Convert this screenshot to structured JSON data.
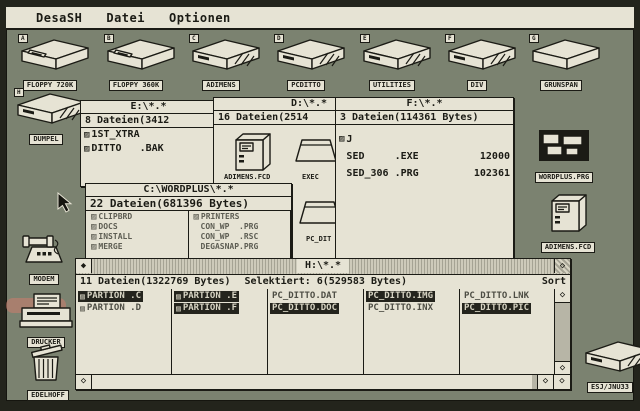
{
  "menu": {
    "items": [
      "DesaSH",
      "Datei",
      "Optionen"
    ]
  },
  "glyphs": {
    "marker": "▨",
    "diamond": "◇",
    "close": "◆"
  },
  "desktop": {
    "drive_icons": [
      {
        "letter": "A",
        "label": "FLOPPY 720K"
      },
      {
        "letter": "B",
        "label": "FLOPPY 360K"
      },
      {
        "letter": "C",
        "label": "ADIMENS"
      },
      {
        "letter": "D",
        "label": "PCDITTO"
      },
      {
        "letter": "E",
        "label": "UTILITIES"
      },
      {
        "letter": "F",
        "label": "DIV"
      },
      {
        "letter": "G",
        "label": "GRÜNSPAN"
      }
    ],
    "side_icons": [
      {
        "letter": "H",
        "label": "DUMPEL"
      },
      {
        "label": "MODEM"
      },
      {
        "label": "DRUCKER"
      },
      {
        "label": "EDELHOFF"
      }
    ],
    "file_icons": [
      {
        "label": "WORDPLUS.PRG"
      },
      {
        "label": "ADIMENS.FCD"
      },
      {
        "label": "ESJ/JNU33"
      }
    ]
  },
  "windows": {
    "e": {
      "title": "E:\\*.*",
      "info": "8 Dateien(3412",
      "files": [
        "1ST_XTRA",
        "DITTO   .BAK"
      ]
    },
    "d": {
      "title": "D:\\*.*",
      "info": "16 Dateien(2514",
      "items": [
        "ADIMENS.FCD",
        "EXEC",
        "PC_DIT"
      ]
    },
    "f": {
      "title": "F:\\*.*",
      "info": "3 Dateien(114361 Bytes)",
      "files": [
        {
          "name": "J",
          "size": ""
        },
        {
          "name": "SED     .EXE",
          "size": "12000"
        },
        {
          "name": "SED_306 .PRG",
          "size": "102361"
        }
      ]
    },
    "c": {
      "title": "C:\\WORDPLUS\\*.*",
      "info": "22 Dateien(681396 Bytes)",
      "col1": [
        "CLIPBRD",
        "DOCS",
        "INSTALL",
        "MERGE"
      ],
      "col2": [
        "PRINTERS",
        "CON_WP  .PRG",
        "CON_WP  .RSC",
        "DEGASNAP.PRG"
      ]
    },
    "h": {
      "title": "H:\\*.*",
      "info": "11 Dateien(1322769 Bytes)",
      "selected_info": "Selektiert: 6(529583 Bytes)",
      "sort_label": "Sort",
      "columns": [
        [
          {
            "name": "PARTION .C",
            "selected": true
          },
          {
            "name": "PARTION .D",
            "selected": false
          }
        ],
        [
          {
            "name": "PARTION .E",
            "selected": true
          },
          {
            "name": "PARTION .F",
            "selected": true
          }
        ],
        [
          {
            "name": "PC_DITTO.DAT",
            "selected": false
          },
          {
            "name": "PC_DITTO.DOC",
            "selected": true
          }
        ],
        [
          {
            "name": "PC_DITTO.IMG",
            "selected": true
          },
          {
            "name": "PC_DITTO.INX",
            "selected": false
          }
        ],
        [
          {
            "name": "PC_DITTO.LNK",
            "selected": false
          },
          {
            "name": "PC_DITTO.PIC",
            "selected": true
          }
        ]
      ]
    }
  }
}
